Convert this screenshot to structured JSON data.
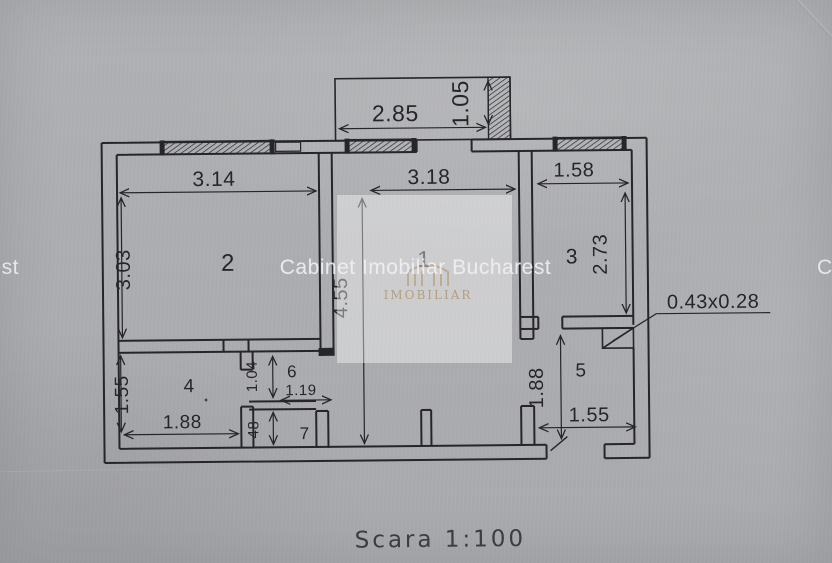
{
  "colors": {
    "paper": "#adaeb1",
    "ink": "#26262a",
    "watermark_gold": "#9e783e",
    "watermark_white": "#eeeff1"
  },
  "watermark": {
    "text": "Cabinet Imobiliar Bucharest",
    "logo_text": "IMOBILIAR"
  },
  "footer": {
    "scale_label": "Scara 1:100"
  },
  "rooms": {
    "r1": "1",
    "r2": "2",
    "r3": "3",
    "r4": "4",
    "r5": "5",
    "r6": "6",
    "r7": "7"
  },
  "dims": {
    "balcony_w": "2.85",
    "balcony_d": "1.05",
    "r2_w": "3.14",
    "r2_h": "3.03",
    "r1_w": "3.18",
    "r1_h": "4.55",
    "r3_w": "1.58",
    "r3_h": "2.73",
    "r4_w": "1.88",
    "r4_h": "1.55",
    "r6_h": "1.04",
    "r6_w": "1.19",
    "r7_h": "48",
    "r5_h": "1.88",
    "r5_w": "1.55",
    "niche": "0.43x0.28"
  }
}
